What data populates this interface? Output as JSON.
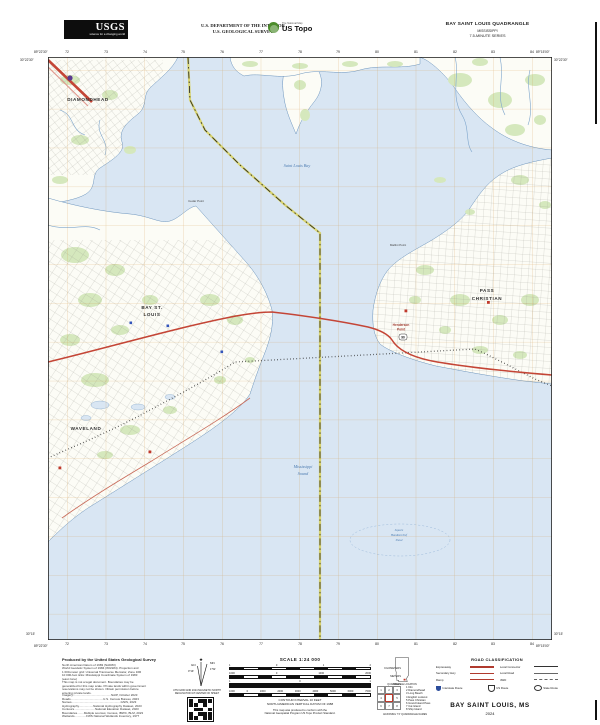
{
  "header": {
    "logo": {
      "name": "USGS",
      "tagline": "science for a changing world"
    },
    "department": [
      "U.S. DEPARTMENT OF THE INTERIOR",
      "U.S. GEOLOGICAL SURVEY"
    ],
    "ustopo": {
      "program": "The National Map",
      "product": "US Topo"
    },
    "quadrangle": {
      "title": "BAY SAINT LOUIS QUADRANGLE",
      "state": "MISSISSIPPI",
      "series": "7.5-MINUTE SERIES"
    }
  },
  "collar": {
    "corners": {
      "top_left_lon": "89°22'30\"",
      "top_right_lon": "89°15'00\"",
      "top_left_lat": "30°22'30\"",
      "bottom_left_lat": "30°15'",
      "top_right_lat": "30°22'30\"",
      "bottom_right_lat": "30°15'",
      "bottom_left_lon": "89°22'30\"",
      "bottom_right_lon": "89°15'00\""
    },
    "grid_numbers": [
      "72",
      "73",
      "74",
      "75",
      "76",
      "77",
      "78",
      "79",
      "80",
      "81",
      "82",
      "83",
      "84"
    ]
  },
  "map": {
    "labels": {
      "diamondhead": "DIAMONDHEAD",
      "bay_st1": "BAY ST.",
      "bay_st2": "LOUIS",
      "waveland": "WAVELAND",
      "pass1": "PASS",
      "pass2": "CHRISTIAN",
      "henderson1": "Henderson",
      "henderson2": "Point",
      "mallini": "Mallini Point",
      "cedar": "Cedar Point",
      "bay_water": "Saint Louis Bay",
      "sound1": "Mississippi",
      "sound2": "Sound",
      "shoal1": "Square",
      "shoal2": "Handkerchief",
      "shoal3": "Shoal",
      "us90_shield": "90"
    },
    "colors": {
      "water": "#d9e6f3",
      "land": "#fcfcf6",
      "veg": "#d5e8bd",
      "grid": "#d08a2e",
      "road": "#c44536",
      "roadminor": "#c96b5a",
      "rail": "#1c1c1c",
      "boundary": "#d8d04e",
      "shore": "#6a93bd",
      "streets": "#95958d"
    }
  },
  "footer": {
    "produced": {
      "heading": "Produced by the United States Geological Survey",
      "fineprint": [
        "North American Datum of 1983 (NAD83)",
        "World Geodetic System of 1984 (WGS84). Projection and",
        "1 000-meter grid: Universal Transverse Mercator, Zone 16R",
        "10 000-foot ticks: Mississippi Coordinate System of 1983",
        "(east zone)",
        "This map is not a legal document. Boundaries may be",
        "generalized for this map scale. Private lands within government",
        "reservations may not be shown. Obtain permission before",
        "entering private lands."
      ],
      "sources": [
        "Imagery..............................................NAIP, October 2023",
        "Roads.......................................U.S. Census Bureau, 2023",
        "Names...........................................................GNIS, 2023",
        "Hydrography.................National Hydrography Dataset, 2023",
        "Contours.........................National Elevation Dataset, 2023",
        "Boundaries........Multiple sources; Census, IBWC, BLM, 2023",
        "Wetlands..............FWS National Wetlands Inventory, 1977"
      ]
    },
    "declination": {
      "star": "★",
      "gn": "GN",
      "mn": "MN",
      "gn_angle": "0°19´",
      "mn_angle": "1°52´",
      "caption1": "UTM GRID AND 2024 MAGNETIC NORTH",
      "caption2": "DECLINATION AT CENTER OF SHEET"
    },
    "scale": {
      "title": "SCALE 1:24 000",
      "captions": {
        "km": "KILOMETERS",
        "m": "METERS",
        "mi": "MILES",
        "ft": "FEET"
      },
      "km_labels": [
        "1",
        "0",
        "1",
        "2"
      ],
      "m_labels": [
        "1000",
        "0",
        "1000",
        "2000"
      ],
      "mi_labels": [
        "1",
        "0",
        "1"
      ],
      "ft_labels": [
        "1000",
        "0",
        "1000",
        "2000",
        "3000",
        "4000",
        "5000",
        "6000",
        "7000"
      ],
      "contour": [
        "CONTOUR INTERVAL 10 FEET",
        "NORTH AMERICAN VERTICAL DATUM OF 1988"
      ],
      "conformity": [
        "This map was produced to conform with the",
        "National Geospatial Program US Topo Product Standard."
      ]
    },
    "quad_location_caption": "QUADRANGLE LOCATION",
    "road_class": {
      "title": "ROAD CLASSIFICATION",
      "items": [
        {
          "label": "Expressway"
        },
        {
          "label": "Local Connector"
        },
        {
          "label": "Secondary Hwy"
        },
        {
          "label": "Local Road"
        },
        {
          "label": "Ramp"
        },
        {
          "label": "4WD"
        }
      ],
      "shields": [
        {
          "label": "Interstate Route"
        },
        {
          "label": "US Route"
        },
        {
          "label": "State Route"
        }
      ]
    },
    "adjoining": {
      "numbers": [
        "1",
        "2",
        "3",
        "4",
        "5",
        "6",
        "7",
        "8"
      ],
      "names": [
        "Kiln",
        "Diamondhead",
        "Long Beach",
        "English Lookout",
        "Pass Christian",
        "Grand Island Pass",
        "Cat Island",
        "Ship Island"
      ],
      "caption": "ADJOINING 7.5' QUADRANGLE NAMES"
    },
    "title_block": {
      "title": "BAY SAINT LOUIS,  MS",
      "year": "2024"
    }
  }
}
